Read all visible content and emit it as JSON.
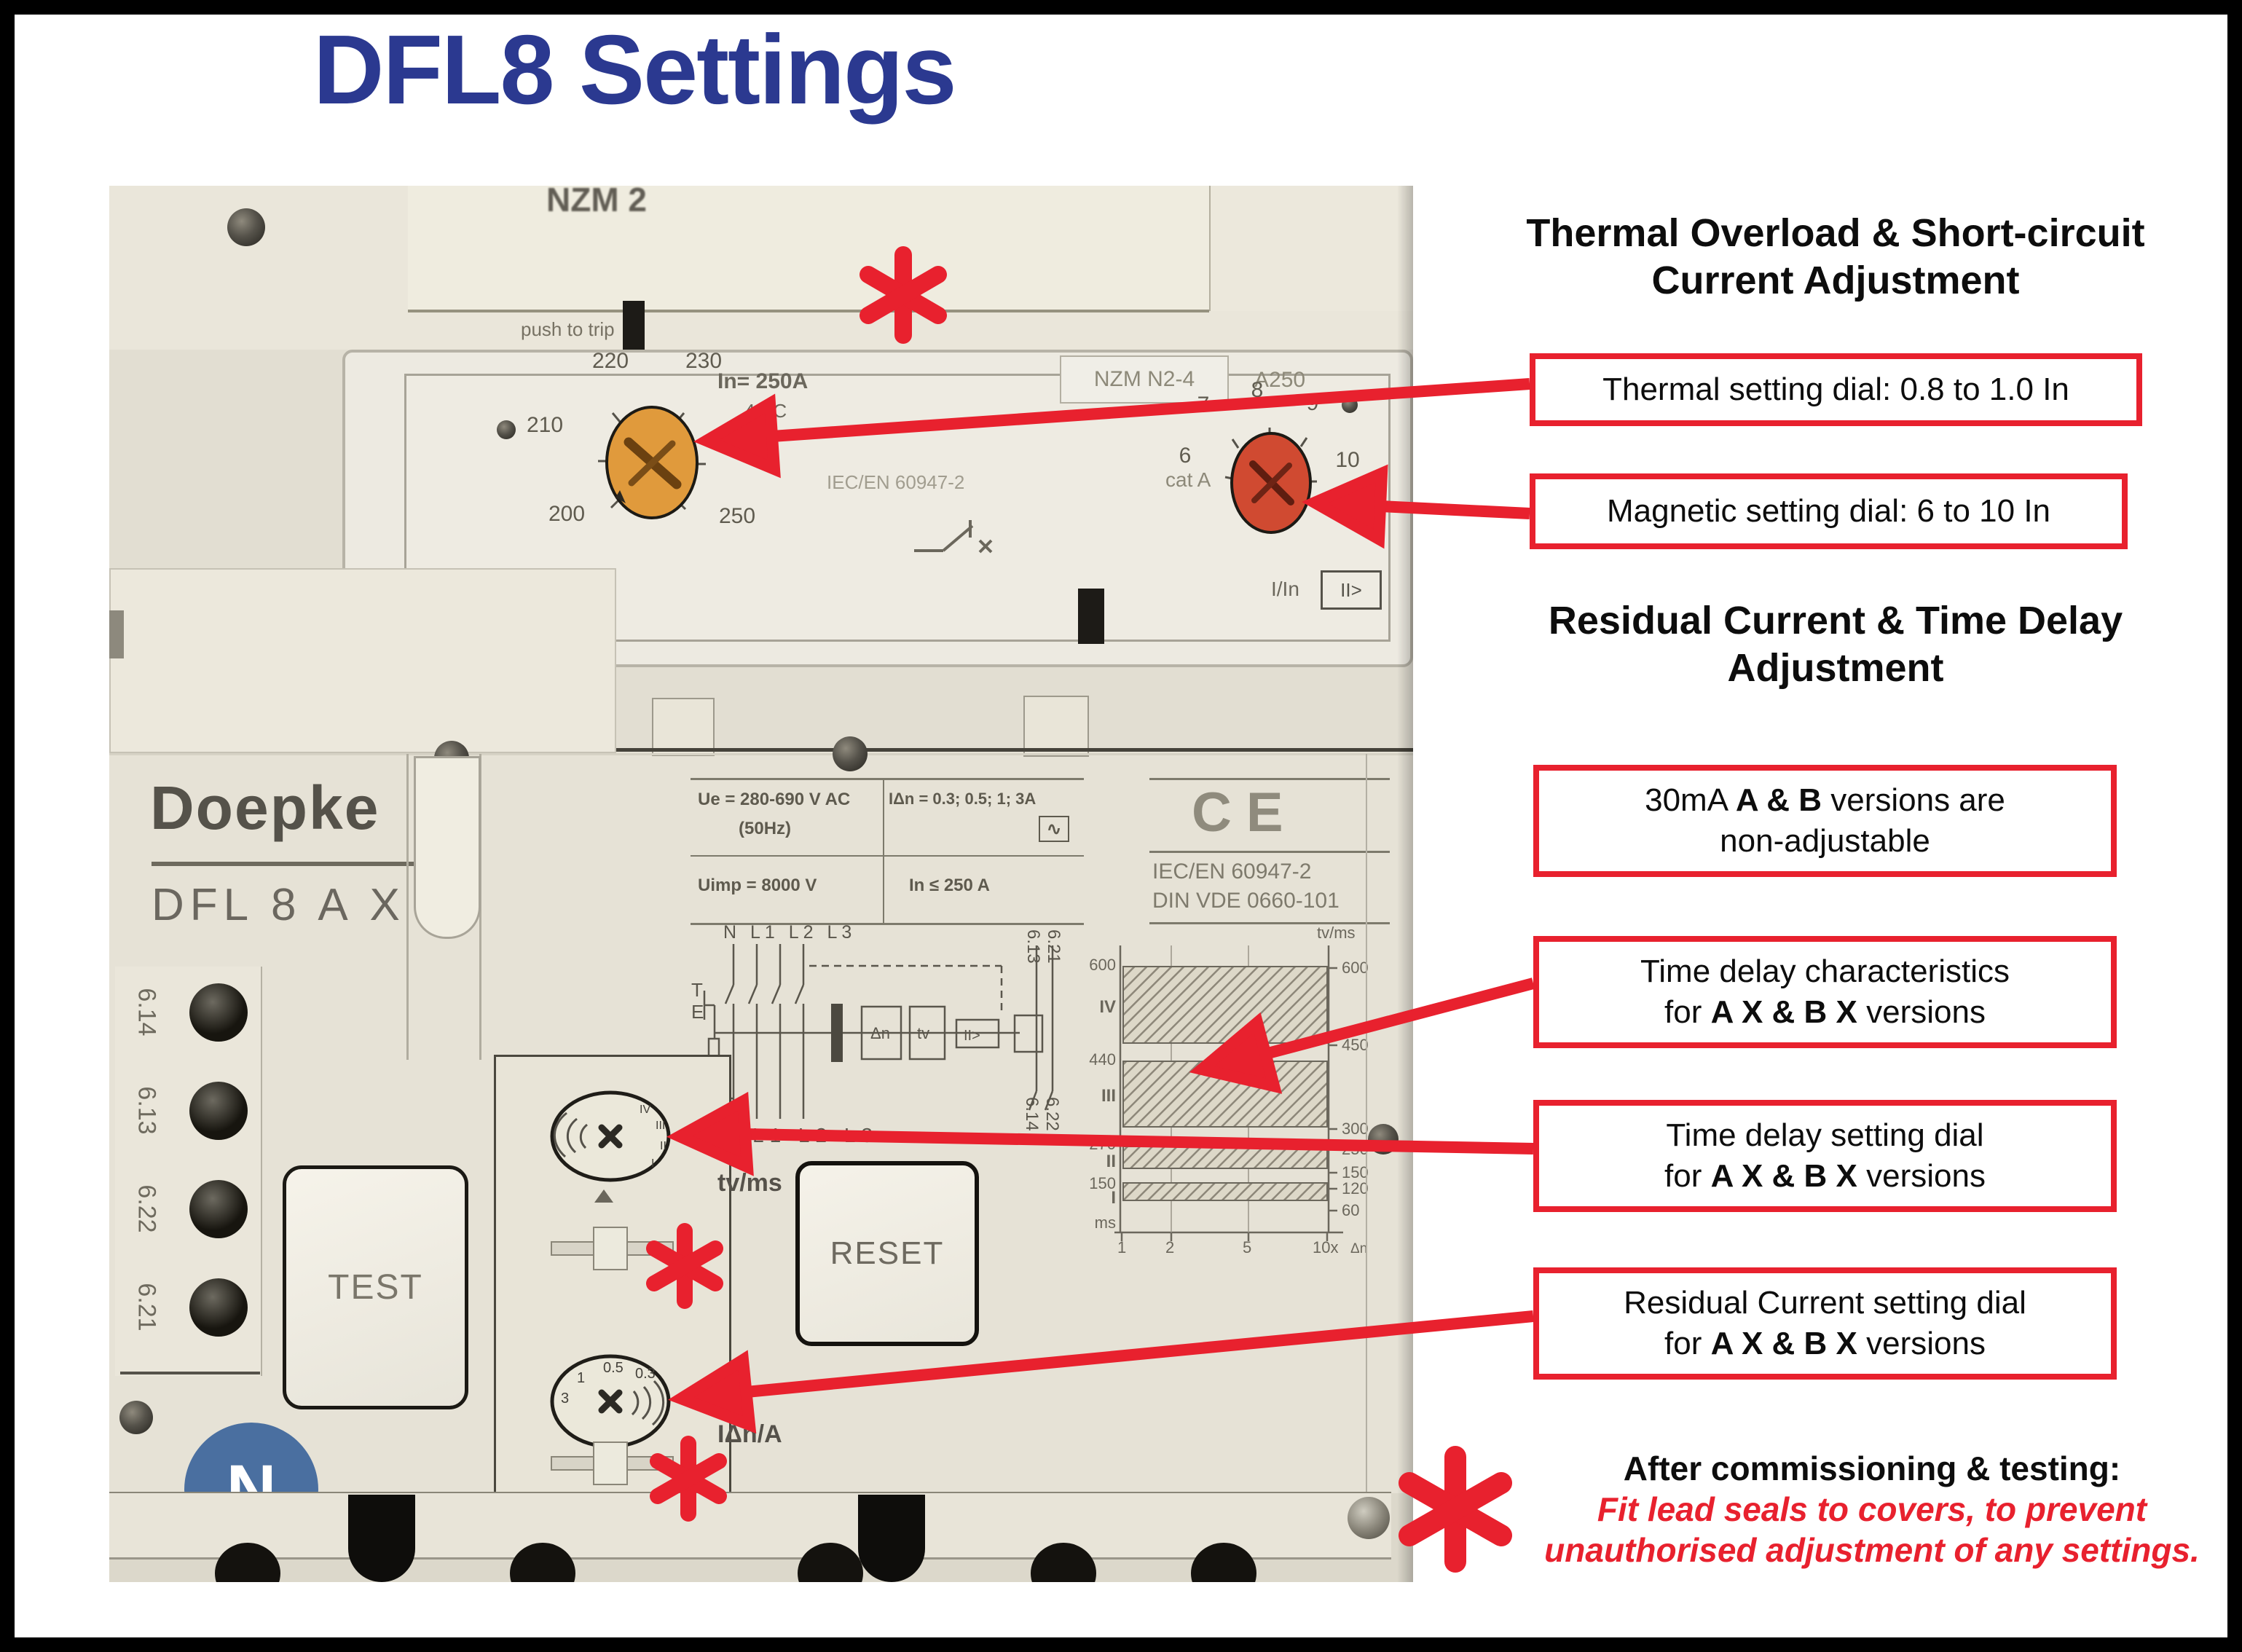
{
  "colors": {
    "accent_red": "#e8212e",
    "title_blue": "#2b3990",
    "breaker_beige": "#e6e2d6",
    "dial_orange": "#e09a3c",
    "dial_red": "#d04a31",
    "n_badge_blue": "#4a6fa0"
  },
  "title": "DFL8 Settings",
  "annotations": {
    "heading1_line1": "Thermal Overload & Short-circuit",
    "heading1_line2": "Current Adjustment",
    "box_thermal": "Thermal setting dial: 0.8 to 1.0 In",
    "box_magnetic": "Magnetic setting dial: 6 to 10 In",
    "heading2_line1": "Residual Current & Time Delay",
    "heading2_line2": "Adjustment",
    "box_30ma": {
      "line1_pre": "30mA ",
      "line1_bold": "A & B",
      "line1_post": " versions are",
      "line2": "non-adjustable"
    },
    "box_characteristics": {
      "line1": "Time delay characteristics",
      "line2_pre": "for ",
      "line2_bold": "A X & B X",
      "line2_post": " versions"
    },
    "box_time_dial": {
      "line1": "Time delay setting dial",
      "line2_pre": "for ",
      "line2_bold": "A X & B X",
      "line2_post": " versions"
    },
    "box_residual_dial": {
      "line1": "Residual Current setting dial",
      "line2_pre": "for ",
      "line2_bold": "A X & B X",
      "line2_post": " versions"
    },
    "footnote": {
      "line1": "After commissioning & testing:",
      "line2": "Fit lead seals to covers, to prevent",
      "line3": "unauthorised adjustment of any settings."
    }
  },
  "device": {
    "top_label": "NZM 2",
    "push_to_trip": "push to trip",
    "cover": {
      "rated_current": "In= 250A",
      "temperature": "40°C",
      "type_label": "NZM N2-4",
      "type_suffix": "A250",
      "standard": "IEC/EN 60947-2",
      "category": "cat A",
      "thermal_scale": [
        "220",
        "230",
        "210",
        "240",
        "200",
        "250"
      ],
      "thermal_unit": "Ir /A",
      "magnetic_scale": [
        "7",
        "8",
        "9",
        "6",
        "10"
      ],
      "magnetic_unit": "I/In",
      "magnetic_symbol": "II>"
    },
    "brand": "Doepke",
    "model": "DFL 8 A X",
    "ratings": {
      "ue": "Ue = 280-690 V AC",
      "ue_freq": "(50Hz)",
      "idn": "IΔn = 0.3; 0.5; 1; 3A",
      "wave": "∿",
      "uimp": "Uimp = 8000 V",
      "in_max": "In ≤ 250 A"
    },
    "approvals": {
      "ce": "CE",
      "std1": "IEC/EN 60947-2",
      "std2": "DIN VDE 0660-101"
    },
    "schematic": {
      "top": "N L1 L2 L3",
      "bottom": "N L1 L2 L3",
      "t": "T",
      "e": "E",
      "b1": "Δn",
      "b2": "tv",
      "b3": "II>",
      "term_top_1": "6.13",
      "term_top_2": "6.21",
      "term_bot_1": "6.14",
      "term_bot_2": "6.22"
    },
    "terminals": [
      "6.14",
      "6.13",
      "6.22",
      "6.21"
    ],
    "buttons": {
      "test": "TEST",
      "reset": "RESET"
    },
    "dials": {
      "time_delay_unit": "tv/ms",
      "time_delay_positions": [
        "I",
        "II",
        "III",
        "IV"
      ],
      "residual_unit": "IΔn/A",
      "residual_scale": [
        "3",
        "1",
        "0.5",
        "0.3"
      ]
    },
    "neutral_badge": "N"
  },
  "chart_data": {
    "type": "area",
    "ylabel": "tv/ms",
    "xlabel": "x IΔn",
    "x_ticks": [
      "1",
      "2",
      "5",
      "10x",
      "Δn"
    ],
    "left_ticks": [
      "600",
      "IV",
      "440",
      "III",
      "270",
      "II",
      "150",
      "I",
      "ms"
    ],
    "right_ticks": [
      "tv/ms",
      "600",
      "450",
      "300",
      "250",
      "150",
      "120",
      "60"
    ],
    "bands": [
      {
        "label": "IV",
        "tv_ms_min": 450,
        "tv_ms_max": 600
      },
      {
        "label": "III",
        "tv_ms_min": 300,
        "tv_ms_max": 440
      },
      {
        "label": "II",
        "tv_ms_min": 150,
        "tv_ms_max": 250
      },
      {
        "label": "I",
        "tv_ms_min": 60,
        "tv_ms_max": 120
      }
    ]
  }
}
